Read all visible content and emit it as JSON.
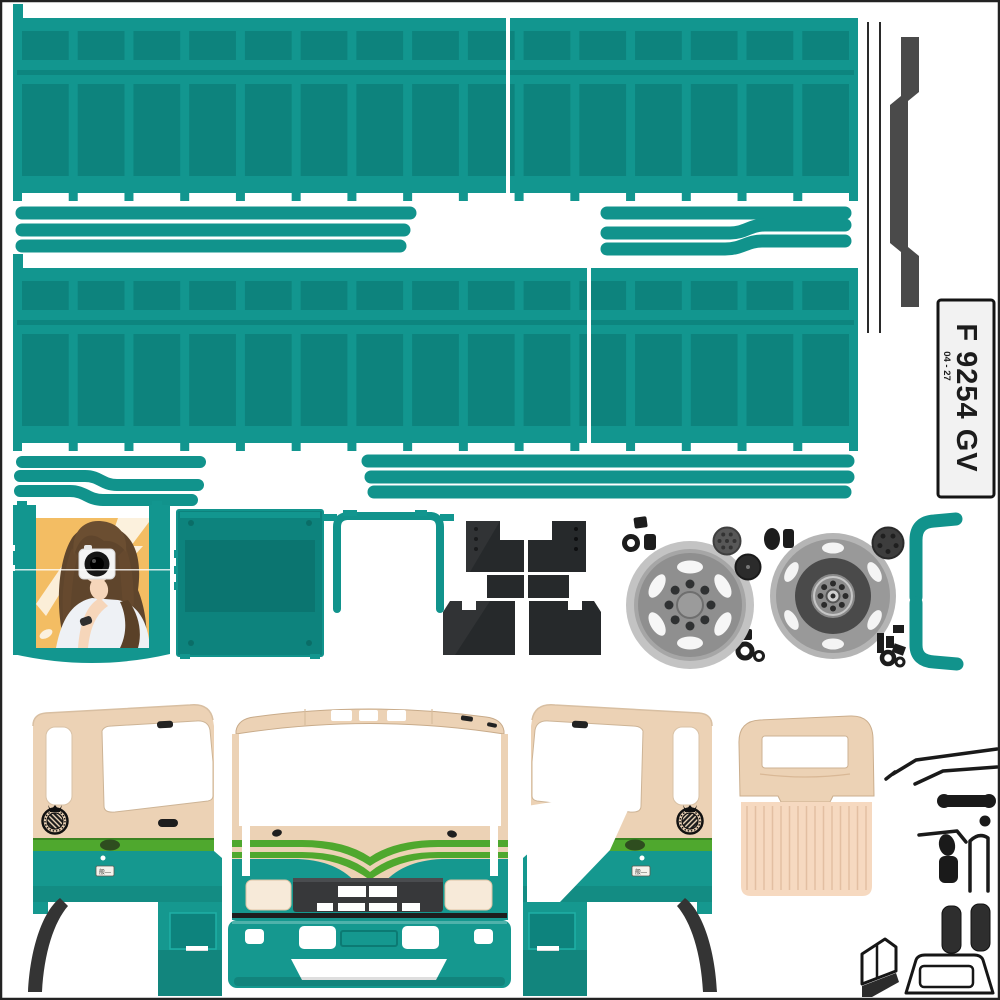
{
  "plate": {
    "serial": "F 9254 GV",
    "expiry": "04 - 27"
  },
  "placard": {
    "text": "般—"
  },
  "colors": {
    "teal_frame": "#12968f",
    "teal_inset": "#0d837d",
    "teal_strip": "#11938c",
    "teal_cab": "#15988f",
    "teal_dark": "#0b7670",
    "cream": "#ecd2b5",
    "cream_light": "#f6d9c0",
    "green": "#4fa82e",
    "green_dark": "#2e6b1a",
    "charcoal": "#26292b",
    "gray_rail": "#4a4a4a",
    "wheel_light": "#c3c3c3",
    "wheel_mid": "#8f8f8f",
    "wheel_dark": "#4a4a4a",
    "photo_bg": "#f3bd63",
    "plate_bg": "#f2f2f2",
    "ink": "#1a1a1a"
  }
}
